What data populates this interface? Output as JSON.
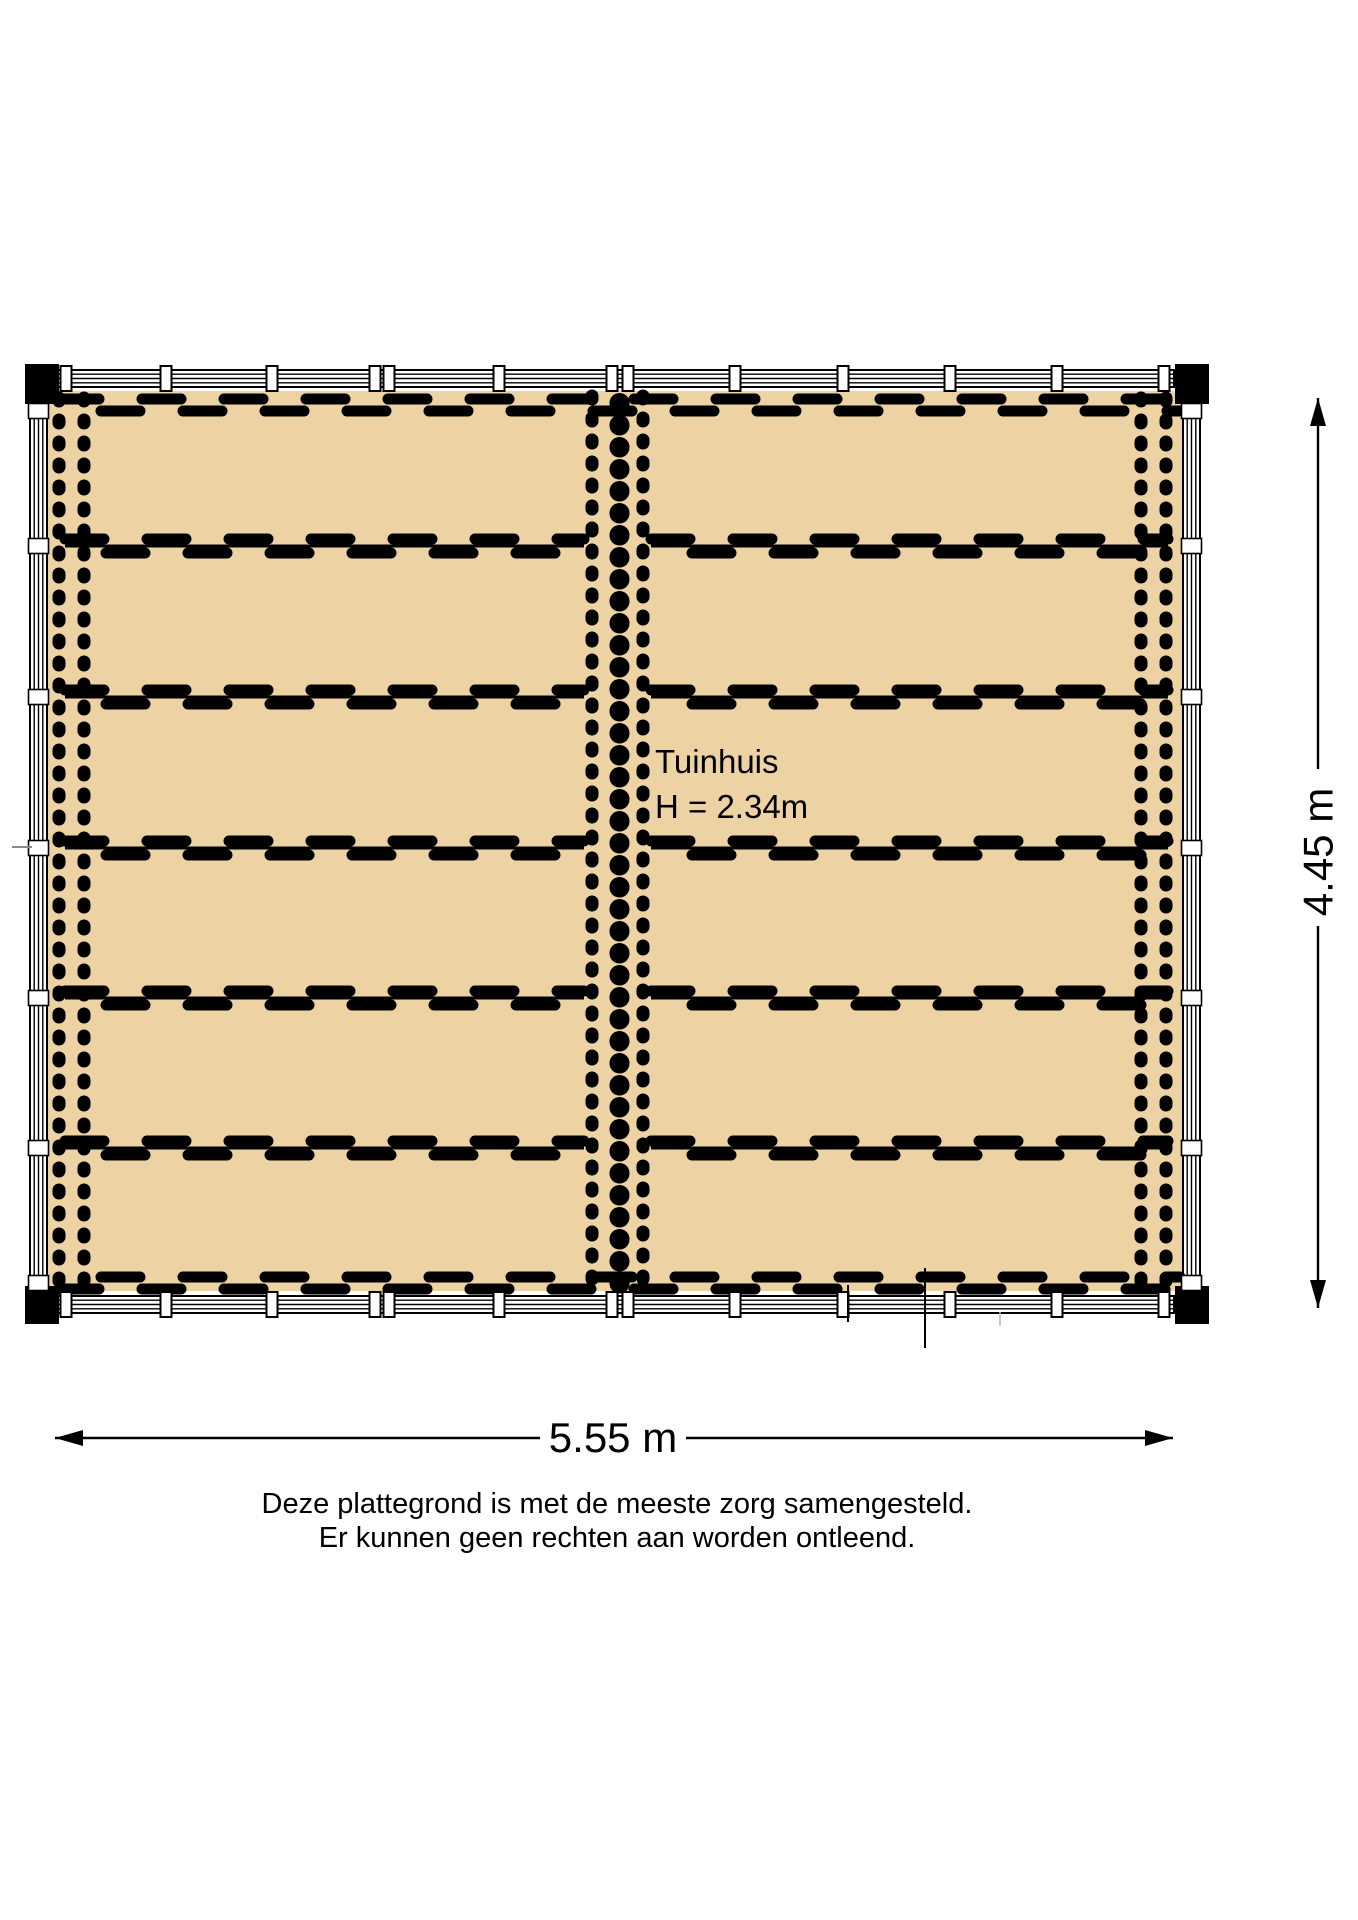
{
  "floorplan": {
    "room_label": "Tuinhuis",
    "room_height_label": "H = 2.34m",
    "dimensions": {
      "width_label": "5.55 m",
      "height_label": "4.45 m"
    },
    "disclaimer_line1": "Deze plattegrond is met de meeste zorg samengesteld.",
    "disclaimer_line2": "Er kunnen geen rechten aan worden ontleend.",
    "colors": {
      "floor_fill": "#EDD3A4",
      "line_color": "#000000",
      "wall_fill": "#FFFFFF"
    }
  }
}
